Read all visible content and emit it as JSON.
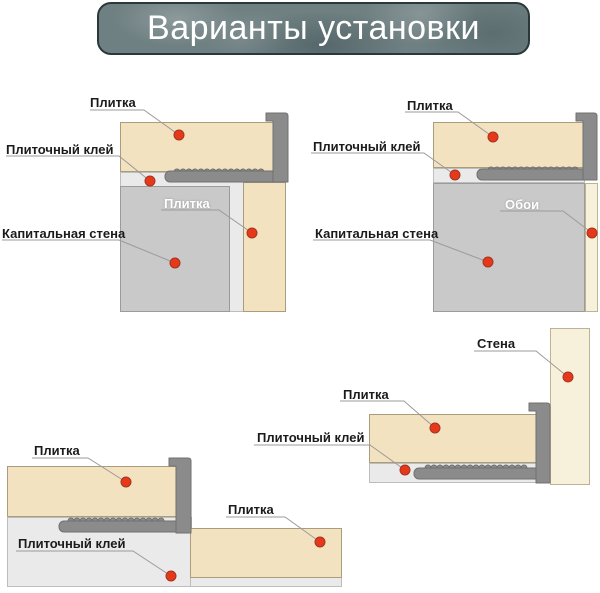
{
  "title": "Варианты установки",
  "colors": {
    "banner_bg": "#6f8082",
    "banner_border": "#2b383a",
    "banner_text": "#ffffff",
    "tile": "#f2e2c0",
    "wall": "#c9c9c9",
    "adhesive": "#eaeaea",
    "wallpaper": "#f7f1dc",
    "profile": "#8b8b8b",
    "marker": "#e6391a",
    "label_text": "#1b1b1b",
    "leader_line": "#9b9b9b"
  },
  "diagrams": {
    "top_left": {
      "labels": {
        "tile_top": "Плитка",
        "adhesive": "Плиточный клей",
        "wall": "Капитальная стена",
        "tile_side": "Плитка"
      }
    },
    "top_right": {
      "labels": {
        "tile_top": "Плитка",
        "adhesive": "Плиточный клей",
        "wall": "Капитальная стена",
        "wallpaper": "Обои"
      }
    },
    "bottom_left": {
      "labels": {
        "tile_top": "Плитка",
        "tile_right": "Плитка",
        "adhesive": "Плиточный клей"
      }
    },
    "bottom_right": {
      "labels": {
        "wall": "Стена",
        "tile": "Плитка",
        "adhesive": "Плиточный клей"
      }
    }
  }
}
